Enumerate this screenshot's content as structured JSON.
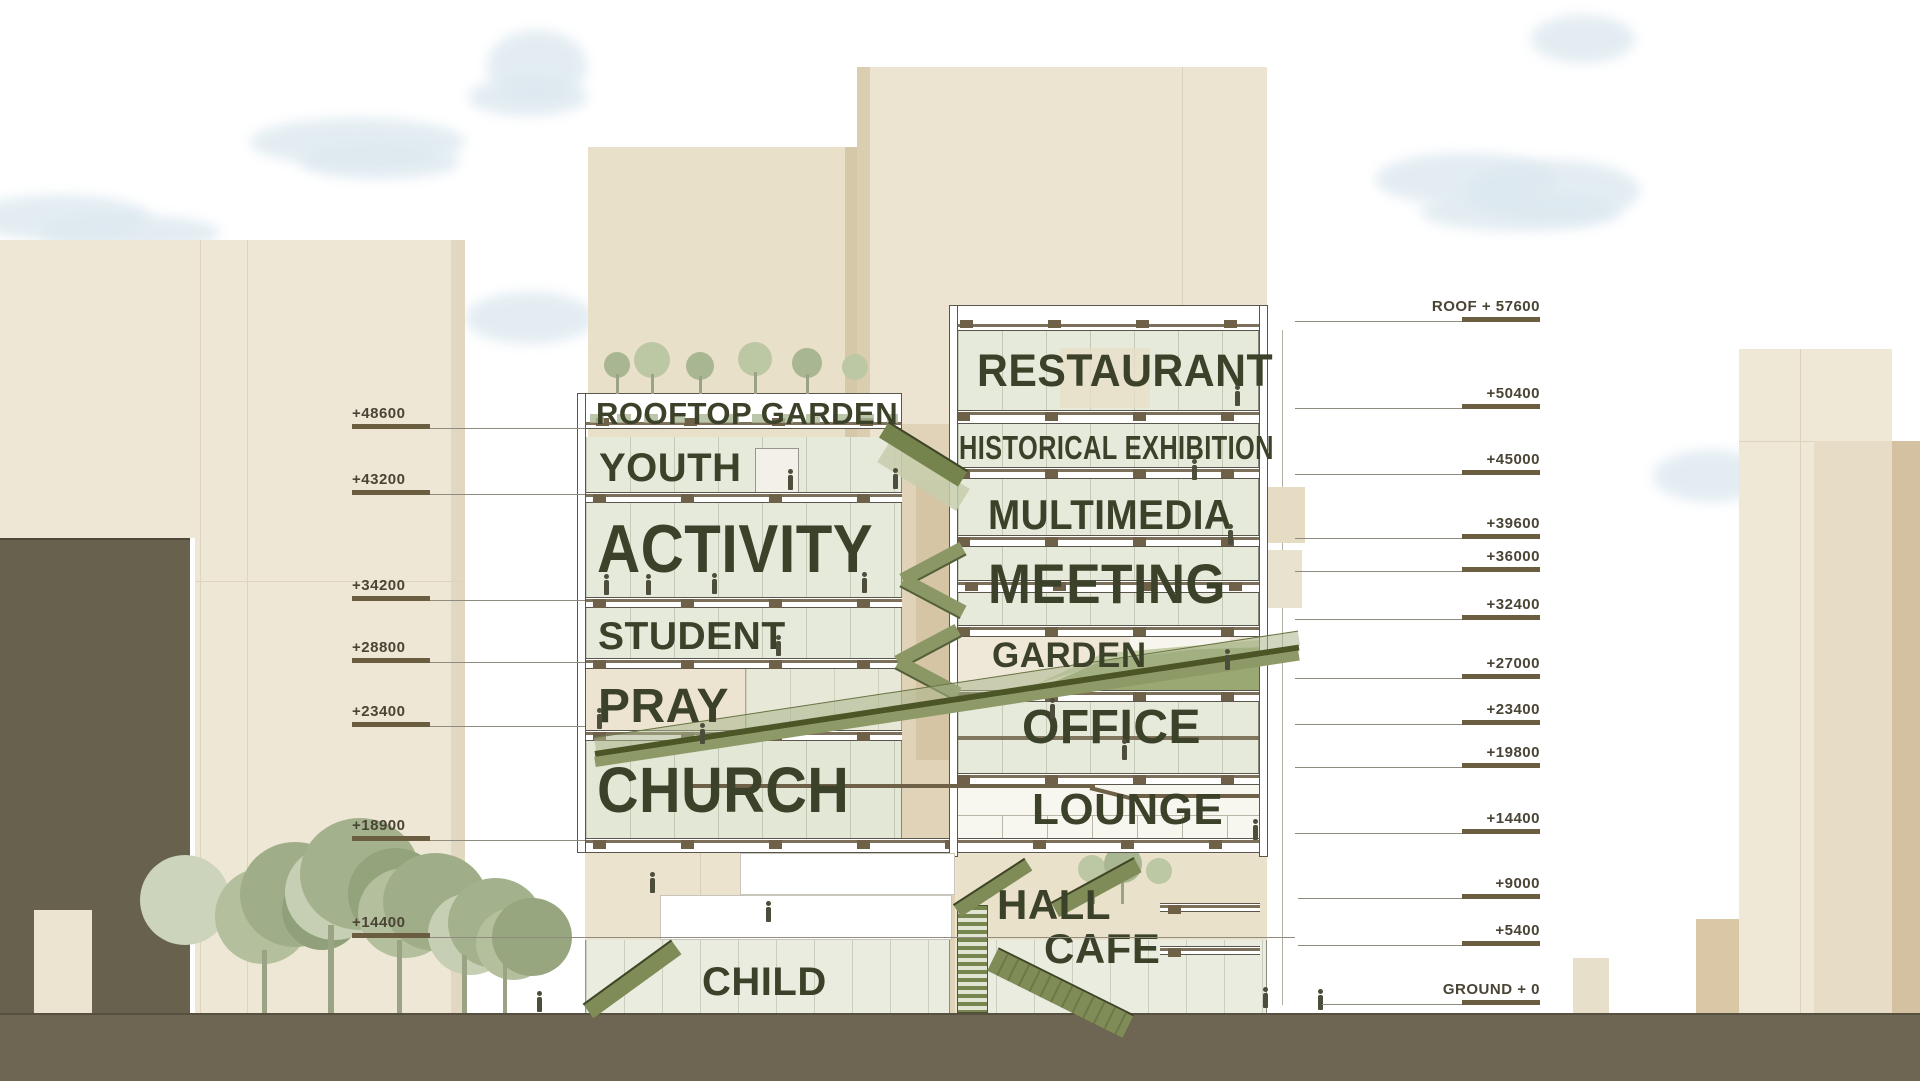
{
  "scene": {
    "type": "architectural section diagram of a mixed-use tower"
  },
  "left_tower": {
    "floors": [
      {
        "label": "ROOFTOP GARDEN"
      },
      {
        "label": "YOUTH"
      },
      {
        "label": "ACTIVITY"
      },
      {
        "label": "STUDENT"
      },
      {
        "label": "PRAY"
      },
      {
        "label": "CHURCH"
      },
      {
        "label": "CHILD"
      }
    ]
  },
  "right_tower": {
    "floors": [
      {
        "label": "RESTAURANT"
      },
      {
        "label": "HISTORICAL EXHIBITION"
      },
      {
        "label": "MULTIMEDIA"
      },
      {
        "label": "MEETING"
      },
      {
        "label": "GARDEN"
      },
      {
        "label": "OFFICE"
      },
      {
        "label": "LOUNGE"
      },
      {
        "label": "HALL"
      },
      {
        "label": "CAFE"
      }
    ]
  },
  "markers_left": [
    {
      "label": "+48600"
    },
    {
      "label": "+43200"
    },
    {
      "label": "+34200"
    },
    {
      "label": "+28800"
    },
    {
      "label": "+23400"
    },
    {
      "label": "+18900"
    },
    {
      "label": "+14400"
    }
  ],
  "markers_right": [
    {
      "label": "ROOF + 57600"
    },
    {
      "label": "+50400"
    },
    {
      "label": "+45000"
    },
    {
      "label": "+39600"
    },
    {
      "label": "+36000"
    },
    {
      "label": "+32400"
    },
    {
      "label": "+27000"
    },
    {
      "label": "+23400"
    },
    {
      "label": "+19800"
    },
    {
      "label": "+14400"
    },
    {
      "label": "+9000"
    },
    {
      "label": "+5400"
    },
    {
      "label": "GROUND + 0"
    }
  ],
  "colors": {
    "label_text": "#3c4129",
    "marker_text": "#4a4435",
    "marker_bar": "#6b5d40",
    "glass": "#e6eadb",
    "stair_green": "#7f8c57",
    "ramp_green": "#8d9a67",
    "ground": "#6e6552",
    "building_beige": "#efe7d6",
    "building_dark": "#68614e",
    "tree_green": "#a3b18c",
    "cloud_blue": "#dce8ef",
    "slab_brown": "#6f6148"
  }
}
